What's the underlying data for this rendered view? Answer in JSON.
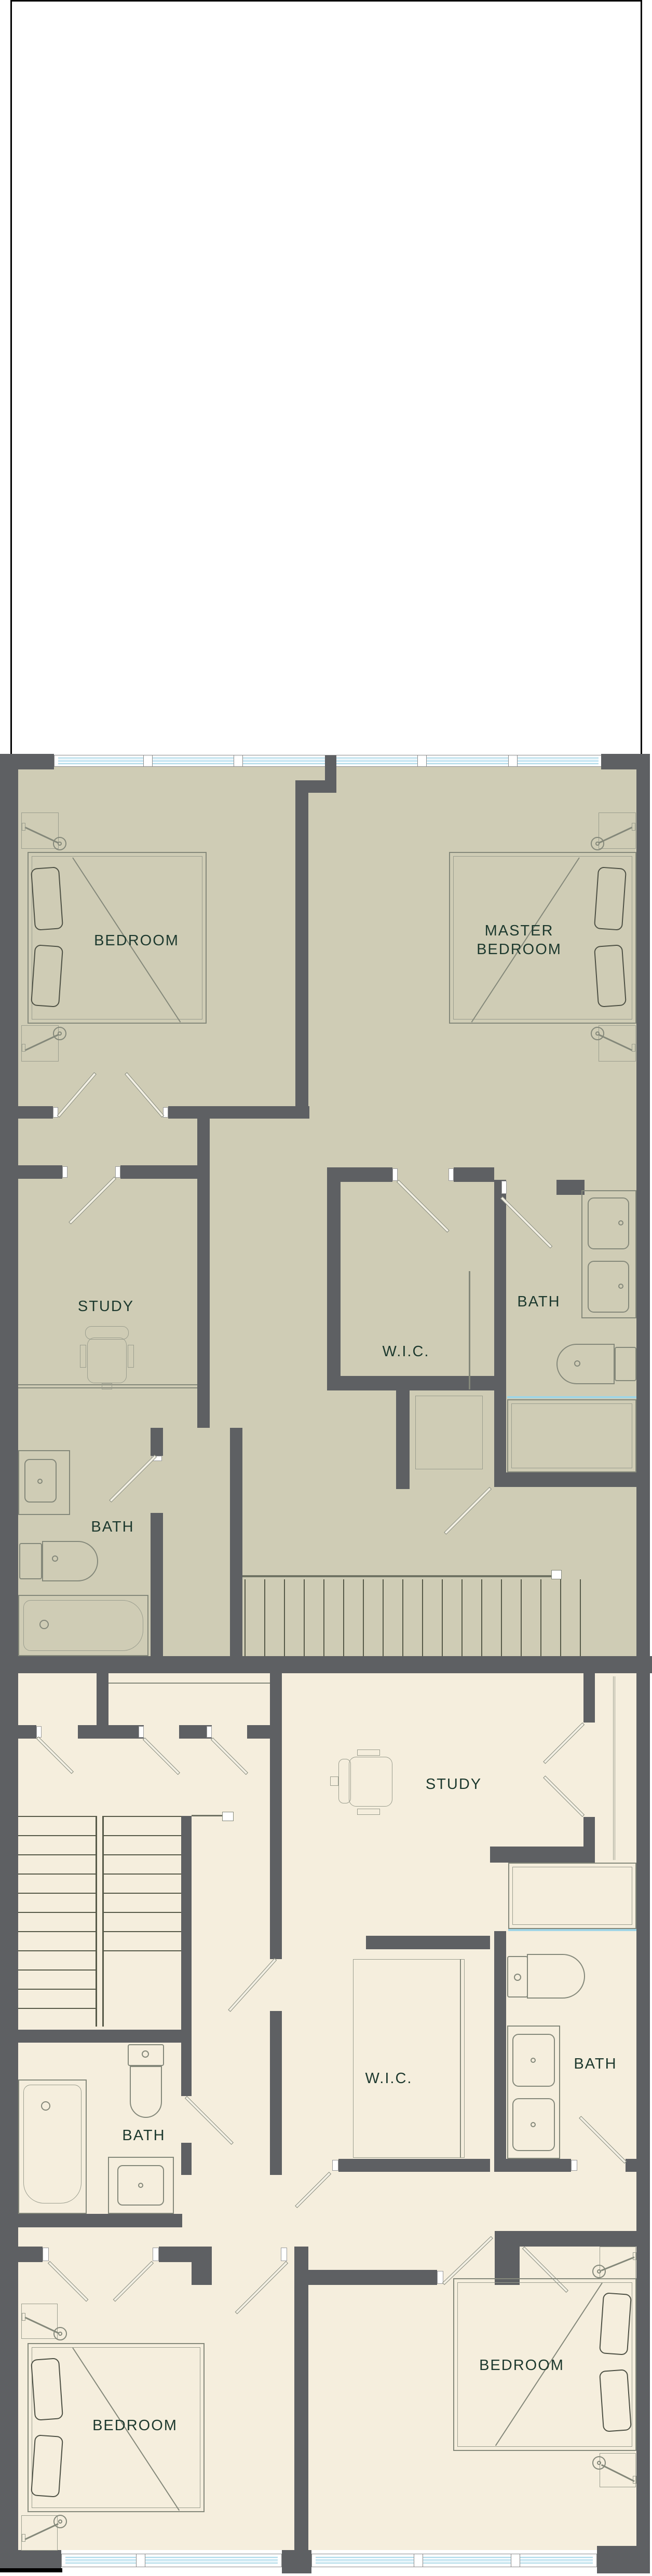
{
  "drawing": {
    "type": "residential floor plan, two stacked storey plans",
    "colors": {
      "wall": "#5e6063",
      "upper_floor": "#cfccb5",
      "lower_floor": "#f5eedd",
      "window_glass": "#cfeaf5",
      "label_text": "#1d392e",
      "fixture_line": "#84887a",
      "border": "#000000"
    }
  },
  "plans": {
    "upper": {
      "rooms": {
        "bedroom": {
          "label": "BEDROOM"
        },
        "master_bedroom": {
          "line1": "MASTER",
          "line2": "BEDROOM"
        },
        "study": {
          "label": "STUDY"
        },
        "wic": {
          "label": "W.I.C."
        },
        "bath_right": {
          "label": "BATH"
        },
        "bath_left": {
          "label": "BATH"
        }
      }
    },
    "lower": {
      "rooms": {
        "study": {
          "label": "STUDY"
        },
        "wic": {
          "label": "W.I.C."
        },
        "bath_right": {
          "label": "BATH"
        },
        "bath_left": {
          "label": "BATH"
        },
        "bedroom_left": {
          "label": "BEDROOM"
        },
        "bedroom_right": {
          "label": "BEDROOM"
        }
      }
    }
  }
}
